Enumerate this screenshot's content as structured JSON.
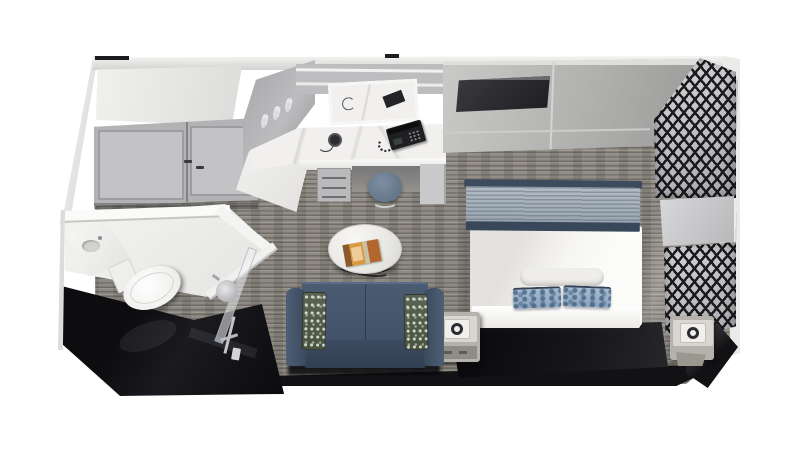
{
  "scene": {
    "type": "3d-floorplan-render",
    "subject": "Interior cruise-ship stateroom shown as a top-down 3D cutaway floor plan on a white background"
  },
  "labels": {
    "room": "Stateroom 3D floor plan render",
    "carpet": "Gray striped carpet floor",
    "left_wall": "Left exterior wall",
    "top_wall": "Back wall top edge",
    "front_wall": "Front wall cross-section",
    "corner_wall": "Front-right wall corner",
    "wardrobe": "Wardrobe with double doors",
    "coat_hooks": "Entry alcove with coat hooks",
    "vanity_desk": "Marble vanity desk",
    "vanity_mirror": "Vanity mirror",
    "telephone": "Desk telephone",
    "hairdryer": "Hairdryer",
    "desk_drawers": "Vanity drawers",
    "desk_stool": "Desk stool",
    "tv_wall": "Back wall panels",
    "tv": "Wall-mounted flat-screen TV",
    "privacy_screen_upper": "Decorative lattice privacy screen (upper section)",
    "privacy_screen_lower": "Decorative lattice privacy screen (lower section)",
    "sheer_curtain": "Sheer curtain",
    "bed": "Queen bed with white duvet",
    "bed_runner": "Textured bed runner with navy trim",
    "white_pillow": "White bolster pillow",
    "blue_pillow_left": "Blue patterned pillow (left)",
    "blue_pillow_right": "Blue patterned pillow (right)",
    "headboard": "Dark upholstered headboard",
    "nightstand_left": "Left nightstand with lamp",
    "nightstand_right": "Right nightstand with lamp",
    "sofa": "Navy sofa",
    "sofa_pillow_left": "Patterned accent pillow (left)",
    "sofa_pillow_right": "Patterned accent pillow (right)",
    "coffee_table": "Round marble coffee table",
    "magazine": "Magazine on table",
    "bathroom": "Bathroom cutaway",
    "bathroom_sink": "Bathroom sink vanity",
    "toilet": "Toilet",
    "shower_head": "Rain shower head",
    "shower_rail": "Shower rail and hand shower",
    "shower_glass": "Glass shower partition",
    "bathroom_floor": "Dark bathroom floor"
  },
  "colors": {
    "bg": "#ffffff",
    "carpet_base": "#8b8780",
    "carpet_light": "#938f88",
    "marble": "#f1f0ee",
    "closet_door": "#b3b3b5",
    "closet_panel": "#c3c3c5",
    "tv": "#1e1e22",
    "lattice_dark": "#1b1b1e",
    "lattice_light": "#d6d6d8",
    "curtain_light": "#ececea",
    "curtain_dark": "#c6c6c4",
    "duvet": "#f6f5f2",
    "runner": "#9aa5b1",
    "navy": "#3d4b5f",
    "pillow_blue": "#8ba2b9",
    "pillow_white": "#efeeea",
    "headboard": "#17171b",
    "sofa": "#4b5b72",
    "sofa_dark": "#314053",
    "sofa_pillow": "#49523f",
    "black_wall": "#121215",
    "bath_floor": "#0a0a0d",
    "fixture": "#efefed",
    "chrome": "#c4c4c8",
    "table_top": "#e8e7e4",
    "table_leg": "#1a1a1c",
    "magazine": "#d99a3f",
    "magazine_rust": "#b3672c",
    "stool": "#5a6b80",
    "nightstand": "#b5b2ad",
    "phone": "#1f1f22"
  }
}
